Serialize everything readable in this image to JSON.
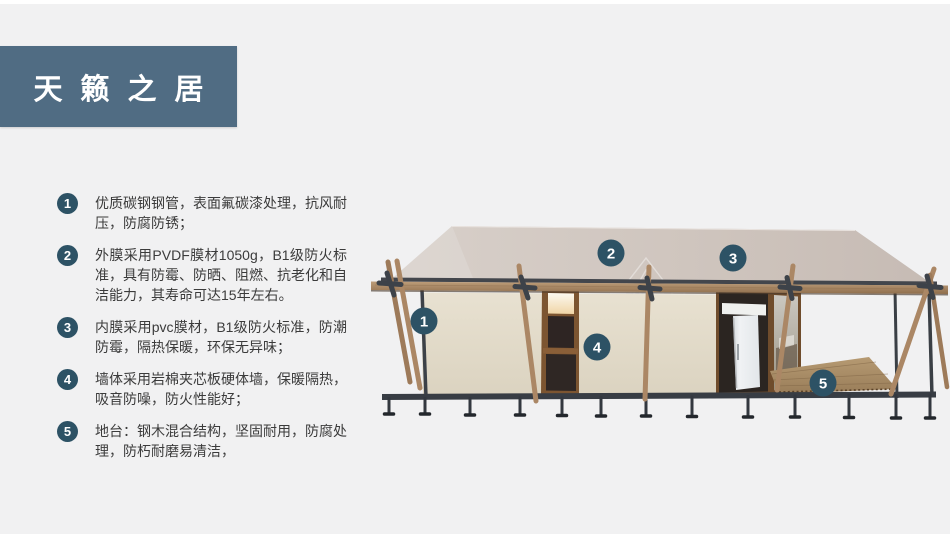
{
  "title": "天籁之居",
  "features": [
    {
      "num": "1",
      "text": "优质碳钢钢管，表面氟碳漆处理，抗风耐压，防腐防锈；"
    },
    {
      "num": "2",
      "text": "外膜采用PVDF膜材1050g，B1级防火标准，具有防霉、防晒、阻燃、抗老化和自洁能力，其寿命可达15年左右。"
    },
    {
      "num": "3",
      "text": "内膜采用pvc膜材，B1级防火标准，防潮防霉，隔热保暖，环保无异味；"
    },
    {
      "num": "4",
      "text": "墙体采用岩棉夹芯板硬体墙，保暖隔热，吸音防噪，防火性能好；"
    },
    {
      "num": "5",
      "text": "地台：钢木混合结构，坚固耐用，防腐处理，防朽耐磨易清洁，"
    }
  ],
  "diagram": {
    "badges": [
      {
        "label": "1"
      },
      {
        "label": "2"
      },
      {
        "label": "3"
      },
      {
        "label": "4"
      },
      {
        "label": "5"
      }
    ],
    "watermark": {
      "cn": "雪利篷房",
      "en": "XUELI TENT"
    }
  },
  "colors": {
    "title_bg": "#506c83",
    "badge": "#2d5265",
    "roof": "#cfc5be",
    "wall": "#e3dccb",
    "wood": "#ab8765",
    "metal": "#383d44",
    "background": "#f1f1f2"
  }
}
